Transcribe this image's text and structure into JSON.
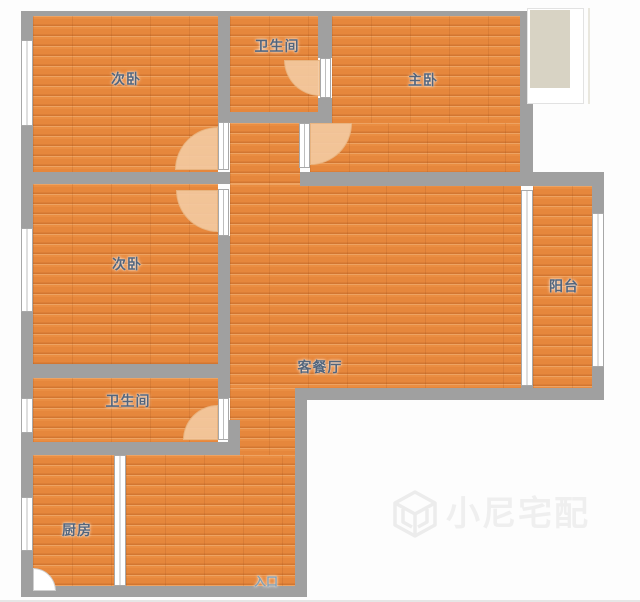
{
  "rooms": [
    {
      "name": "bedroom-top",
      "label": "次卧"
    },
    {
      "name": "bathroom-top",
      "label": "卫生间"
    },
    {
      "name": "master-bedroom",
      "label": "主卧"
    },
    {
      "name": "bedroom-middle",
      "label": "次卧"
    },
    {
      "name": "balcony",
      "label": "阳台"
    },
    {
      "name": "living-dining",
      "label": "客餐厅"
    },
    {
      "name": "bathroom-lower",
      "label": "卫生间"
    },
    {
      "name": "kitchen",
      "label": "厨房"
    },
    {
      "name": "entrance",
      "label": "入口"
    }
  ],
  "watermark": {
    "text": "小尼宅配",
    "icon": "cube-logo"
  },
  "colors": {
    "floor": "#e6873c",
    "wall": "#a0a0a0",
    "door_arc": "#f3c9a0",
    "bay_fill": "#d8d3c4",
    "label": "#53657c",
    "entrance_label": "#85a0b2",
    "watermark": "#efefef"
  }
}
